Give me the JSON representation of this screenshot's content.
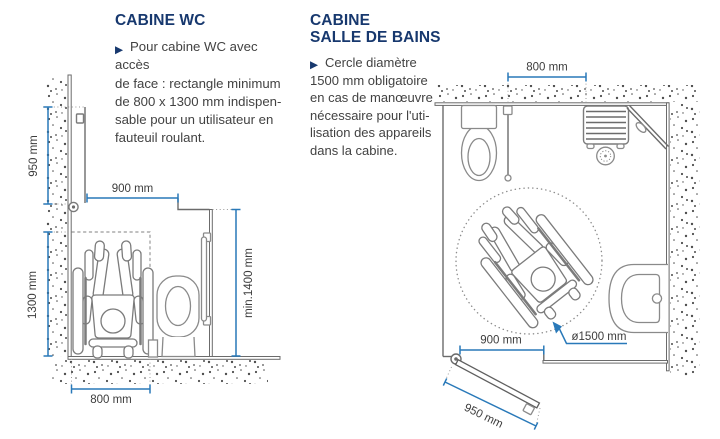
{
  "page": {
    "background": "#ffffff"
  },
  "colors": {
    "title_navy": "#17386e",
    "body_text": "#424242",
    "dimension_blue": "#2979b9",
    "line_gray": "#6b6b6b",
    "stipple_gray": "#4d4d4d"
  },
  "icons": {
    "bullet": "▶"
  },
  "sections": {
    "wc": {
      "title": "CABINE WC",
      "body": "Pour cabine WC avec accès\nde face : rectangle minimum\nde 800 x 1300 mm indispen-\nsable pour un utilisateur en\nfauteuil roulant."
    },
    "bathroom": {
      "title_line1": "CABINE",
      "title_line2": "SALLE DE BAINS",
      "body": "Cercle diamètre\n1500 mm obligatoire\nen cas de manœuvre\nnécessaire pour l'uti-\nlisation des appareils\ndans la cabine."
    }
  },
  "wc_diagram": {
    "dim_door_width": "950 mm",
    "dim_clearance_width": "900 mm",
    "dim_rect_depth": "1300 mm",
    "dim_rect_width": "800 mm",
    "dim_min_height": "min.1400 mm"
  },
  "bath_diagram": {
    "dim_shower_width": "800 mm",
    "dim_door_opening": "900 mm",
    "dim_door_leaf": "950 mm",
    "dim_turning_circle": "ø1500 mm"
  }
}
